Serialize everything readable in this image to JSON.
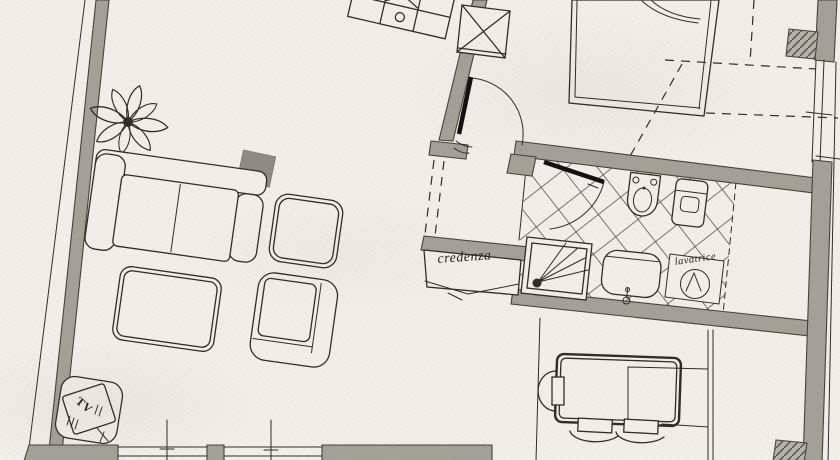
{
  "labels": {
    "credenza": "credenza",
    "lavatrice": "lavatrice",
    "tv": "TV"
  },
  "colors": {
    "paper": "#f1efe9",
    "ink": "#2e2d28",
    "wall": "#a3a198",
    "furn-dark": "#8e8d85"
  },
  "elements": {
    "plant": "potted-plant",
    "sofa": "sofa",
    "side_table": "side-table",
    "square_chair": "square-armchair",
    "coffee_table": "coffee-table",
    "armchair": "armchair",
    "tv_unit": "tv-stand",
    "credenza": "sideboard",
    "shower": "shower-box",
    "sink": "washbasin",
    "bidet": "bidet",
    "toilet": "toilet",
    "washing_machine": "washing-machine",
    "bed": "double-bed",
    "dining_table": "table-with-chairs",
    "shelf": "shelf-unit",
    "shaft": "crossed-duct-box"
  }
}
